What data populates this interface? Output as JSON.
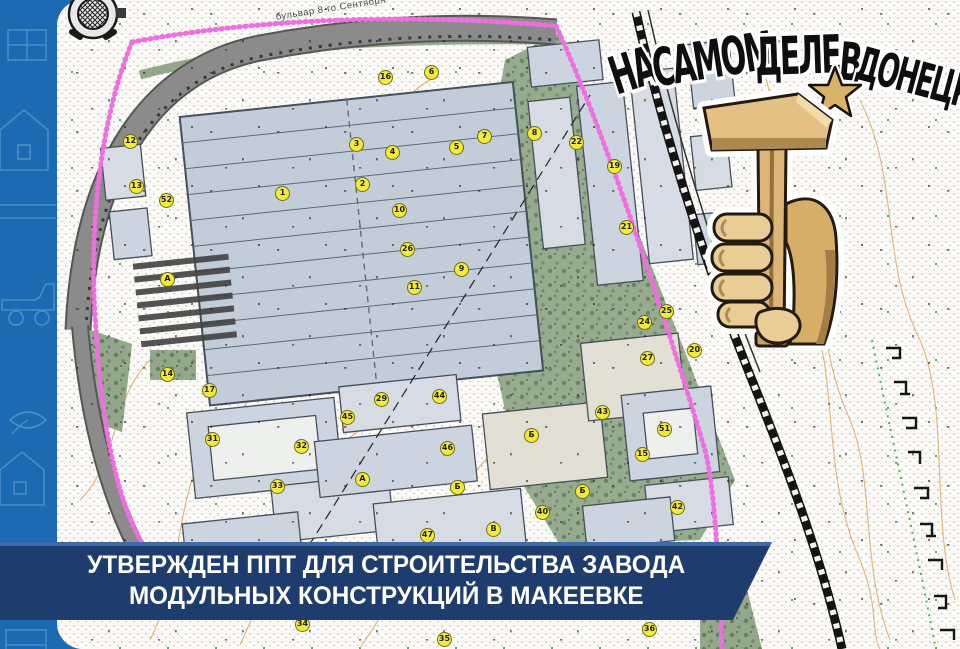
{
  "banner": {
    "line1": "УТВЕРЖДЕН ППТ ДЛЯ СТРОИТЕЛЬСТВА ЗАВОДА",
    "line2": "МОДУЛЬНЫХ КОНСТРУКЦИЙ В МАКЕЕВКЕ",
    "bg_color": "#1e3c6d",
    "text_color": "#ffffff"
  },
  "watermark": {
    "full_text": "НА САМОМ ДЕЛЕ В ДОНЕЦКЕ",
    "words": [
      "НА",
      "САМОМ",
      "ДЕЛЕ",
      "В",
      "ДОНЕЦКЕ"
    ],
    "text_color": "#0e0e0e",
    "star_color": "#d9b26a",
    "logo": "fist-holding-hammer"
  },
  "map": {
    "street_label": "бульвар 8-го Сентября",
    "boundary_color": "#ef6fe0",
    "marker_fill": "#f2ea3f",
    "markers": [
      {
        "x": 131,
        "y": 142,
        "t": "12"
      },
      {
        "x": 137,
        "y": 187,
        "t": "13"
      },
      {
        "x": 167,
        "y": 201,
        "t": "52"
      },
      {
        "x": 283,
        "y": 194,
        "t": "1"
      },
      {
        "x": 386,
        "y": 78,
        "t": "16"
      },
      {
        "x": 432,
        "y": 73,
        "t": "6"
      },
      {
        "x": 457,
        "y": 148,
        "t": "5"
      },
      {
        "x": 485,
        "y": 137,
        "t": "7"
      },
      {
        "x": 535,
        "y": 134,
        "t": "8"
      },
      {
        "x": 393,
        "y": 153,
        "t": "4"
      },
      {
        "x": 357,
        "y": 145,
        "t": "3"
      },
      {
        "x": 363,
        "y": 185,
        "t": "2"
      },
      {
        "x": 400,
        "y": 211,
        "t": "10"
      },
      {
        "x": 408,
        "y": 250,
        "t": "26"
      },
      {
        "x": 415,
        "y": 288,
        "t": "11"
      },
      {
        "x": 462,
        "y": 270,
        "t": "9"
      },
      {
        "x": 577,
        "y": 143,
        "t": "22"
      },
      {
        "x": 615,
        "y": 167,
        "t": "19"
      },
      {
        "x": 627,
        "y": 228,
        "t": "21"
      },
      {
        "x": 667,
        "y": 312,
        "t": "25"
      },
      {
        "x": 645,
        "y": 323,
        "t": "24"
      },
      {
        "x": 648,
        "y": 359,
        "t": "27"
      },
      {
        "x": 695,
        "y": 351,
        "t": "20"
      },
      {
        "x": 603,
        "y": 413,
        "t": "43"
      },
      {
        "x": 665,
        "y": 430,
        "t": "51"
      },
      {
        "x": 643,
        "y": 455,
        "t": "15"
      },
      {
        "x": 583,
        "y": 492,
        "t": "Б"
      },
      {
        "x": 678,
        "y": 508,
        "t": "42"
      },
      {
        "x": 168,
        "y": 280,
        "t": "А"
      },
      {
        "x": 168,
        "y": 375,
        "t": "14"
      },
      {
        "x": 210,
        "y": 391,
        "t": "17"
      },
      {
        "x": 213,
        "y": 440,
        "t": "31"
      },
      {
        "x": 302,
        "y": 447,
        "t": "32"
      },
      {
        "x": 278,
        "y": 487,
        "t": "33"
      },
      {
        "x": 348,
        "y": 418,
        "t": "45"
      },
      {
        "x": 382,
        "y": 400,
        "t": "29"
      },
      {
        "x": 440,
        "y": 397,
        "t": "44"
      },
      {
        "x": 448,
        "y": 449,
        "t": "46"
      },
      {
        "x": 363,
        "y": 480,
        "t": "А"
      },
      {
        "x": 458,
        "y": 488,
        "t": "Б"
      },
      {
        "x": 532,
        "y": 436,
        "t": "Б"
      },
      {
        "x": 543,
        "y": 513,
        "t": "40"
      },
      {
        "x": 428,
        "y": 536,
        "t": "47"
      },
      {
        "x": 494,
        "y": 530,
        "t": "В"
      },
      {
        "x": 303,
        "y": 625,
        "t": "34"
      },
      {
        "x": 445,
        "y": 640,
        "t": "35"
      },
      {
        "x": 650,
        "y": 630,
        "t": "36"
      }
    ]
  },
  "icons": {
    "compass": "compass-rose-icon",
    "star": "star-icon",
    "logo": "hammer-fist-logo"
  },
  "colors": {
    "border_strip": "#1c6ab1",
    "doodle": "#4e92c8",
    "page": "#fbfaf6",
    "road": "#8b8b8b",
    "building_roof": "#c3cdda",
    "park_green": "#93a88b",
    "railway": "#141414"
  }
}
